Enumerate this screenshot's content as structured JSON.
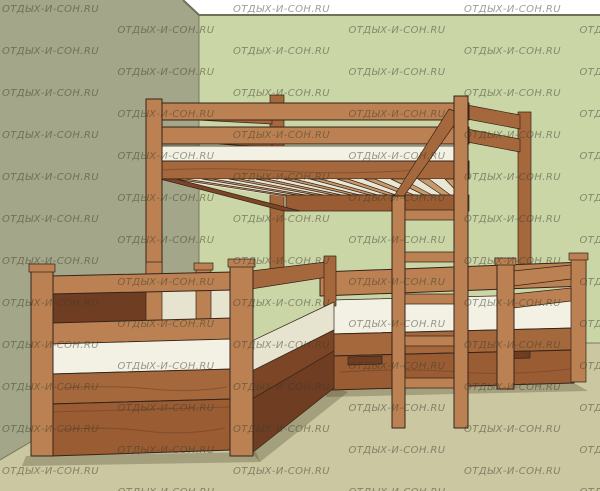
{
  "canvas": {
    "width": 600,
    "height": 491
  },
  "watermark": {
    "text": "ОТДЫХ-И-СОН.RU",
    "opacity": 0.5,
    "font_size": 10,
    "letter_spacing": 0.4,
    "columns": 6,
    "rows": 12,
    "col_spacing": 115.5,
    "row_spacing": 42,
    "stagger_offset": 21,
    "start_x": 2,
    "start_y": 12
  },
  "colors": {
    "background": "#ffffff",
    "left_wall": "#a3a688",
    "back_wall": "#cbd6a7",
    "floor": "#cac7a1",
    "wall_edge_line": "#6f7157",
    "wood_light": "#bc8152",
    "wood_mid": "#a5683c",
    "wood_panel": "#9a5c33",
    "wood_dark": "#7c4626",
    "wood_deep": "#6e3d22",
    "outline": "#35241a",
    "slat": "#c79a6b",
    "slat_gap": "#eae6d4",
    "mattress": "#f2f1e4",
    "mattress_shade": "#e6e3cf",
    "grain": "#6b3a1d",
    "shadow": "rgba(75,65,42,0.30)",
    "watermark": "#3c3d2c"
  }
}
